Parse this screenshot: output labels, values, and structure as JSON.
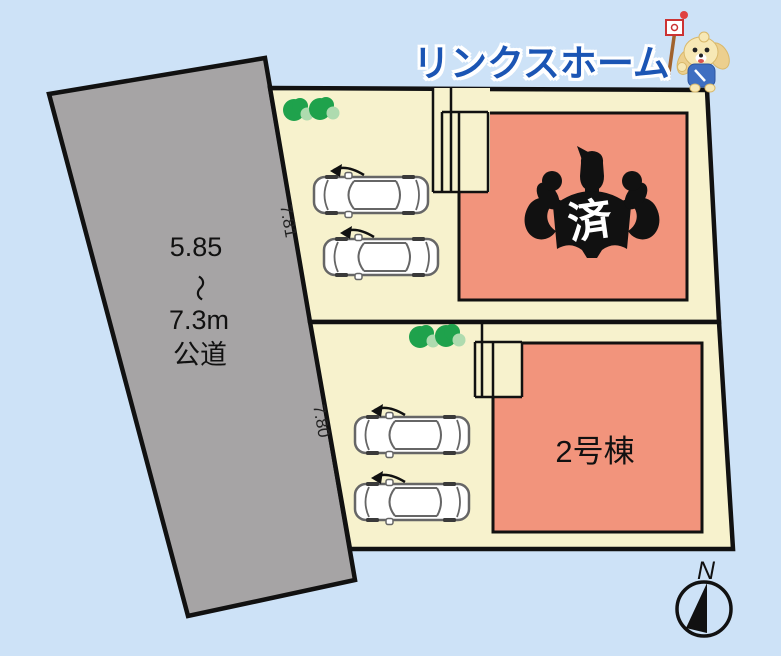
{
  "header": {
    "brand": "リンクスホーム"
  },
  "road": {
    "width_min": "5.85",
    "tilde": "〜",
    "width_max": "7.3m",
    "type": "公道"
  },
  "frontage": {
    "plot1": "7.81",
    "plot2": "7.80"
  },
  "buildings": {
    "plot1_sold_stamp": "済",
    "plot2_label": "2号棟"
  },
  "compass": {
    "north_label": "N"
  },
  "icons": {
    "mascot": "dog-mascot-icon",
    "sold_mark": "muscleman-silhouette",
    "parking": "car-top-view-icon",
    "planting": "bush-icon",
    "direction": "compass-north-icon"
  },
  "colors": {
    "background": "#cde2f7",
    "road_gray": "#a6a4a5",
    "plot_cream": "#f7f2cd",
    "building_salmon": "#f2947c",
    "outline_black": "#111111",
    "bush_green": "#1fa24c",
    "bush_light_green": "#aedbaf",
    "brand_blue": "#1b55b4"
  }
}
